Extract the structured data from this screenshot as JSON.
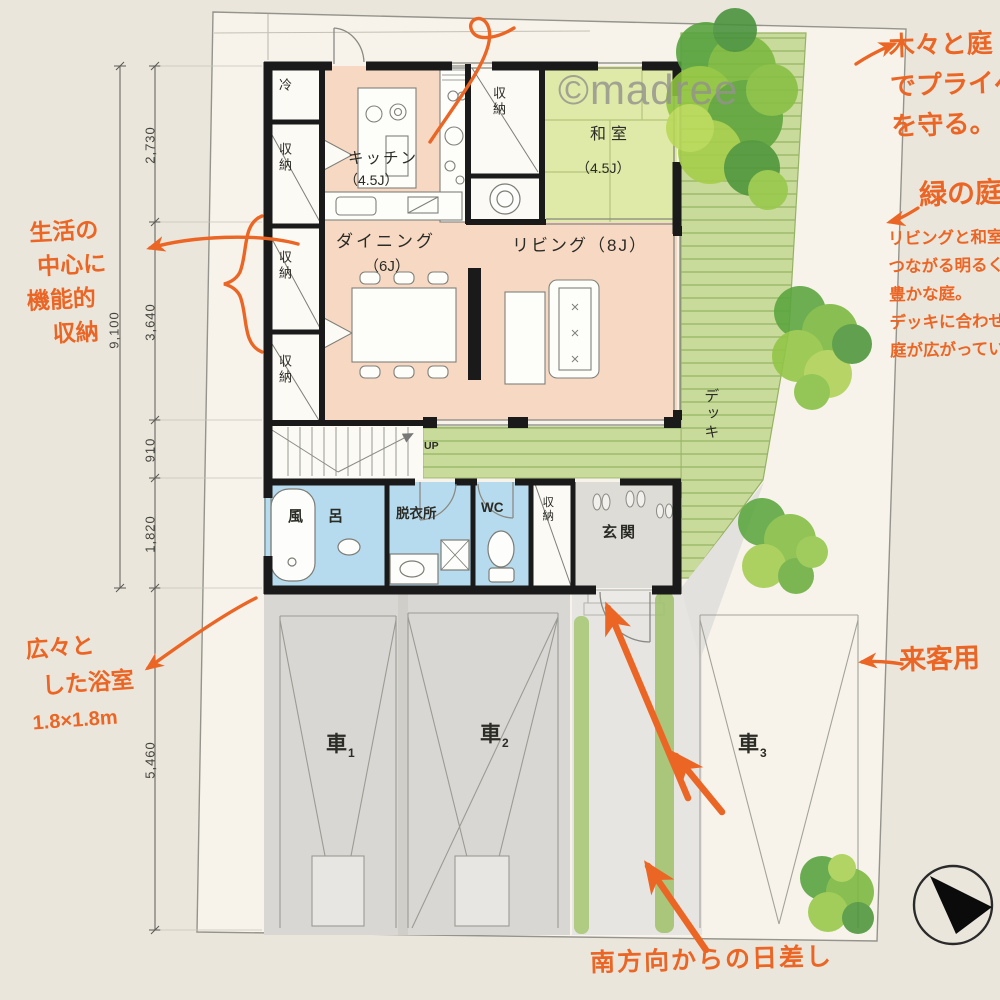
{
  "watermark": "©madree",
  "annotations": {
    "privacy": {
      "lines": [
        "木々と庭",
        "でプライベ",
        "を守る。"
      ]
    },
    "garden": {
      "title": "緑の庭",
      "lines": [
        "リビングと和室に",
        "つながる明るく、緑",
        "豊かな庭。",
        "デッキに合わせて",
        "庭が広がっている"
      ]
    },
    "storage": {
      "lines": [
        "生活の",
        "中心に",
        "機能的",
        "収納"
      ]
    },
    "bath": {
      "lines": [
        "広々と",
        "した浴室",
        "1.8×1.8m"
      ]
    },
    "guest": "来客用",
    "south_sun": "南方向からの日差し"
  },
  "rooms": {
    "kitchen": "キッチン",
    "kitchen_size": "（4.5J）",
    "dining": "ダイニング",
    "dining_size": "（6J）",
    "living": "リビング（8J）",
    "washitsu": "和室",
    "washitsu_size": "（4.5J）",
    "bath_fu": "風",
    "bath_ro": "呂",
    "dressing": "脱衣所",
    "wc": "WC",
    "storage": "収納",
    "fridge": "冷",
    "genkan": "玄関",
    "deck": "デッキ",
    "up": "UP"
  },
  "cars": [
    {
      "label": "車",
      "no": "1"
    },
    {
      "label": "車",
      "no": "2"
    },
    {
      "label": "車",
      "no": "3"
    }
  ],
  "dimensions": {
    "overall": "9,100",
    "seg_2730": "2,730",
    "seg_3640": "3,640",
    "seg_910": "910",
    "seg_1820": "1,820",
    "lower_5460": "5,460"
  },
  "colors": {
    "accent_orange": "#eb6524",
    "floor_peach": "#f7d9c3",
    "tatami_green": "#dfe9a8",
    "deck_green": "#c9db9a",
    "water_blue": "#b7dbee",
    "wall_black": "#1a1a1a",
    "garage_gray": "#d8d7d3"
  }
}
